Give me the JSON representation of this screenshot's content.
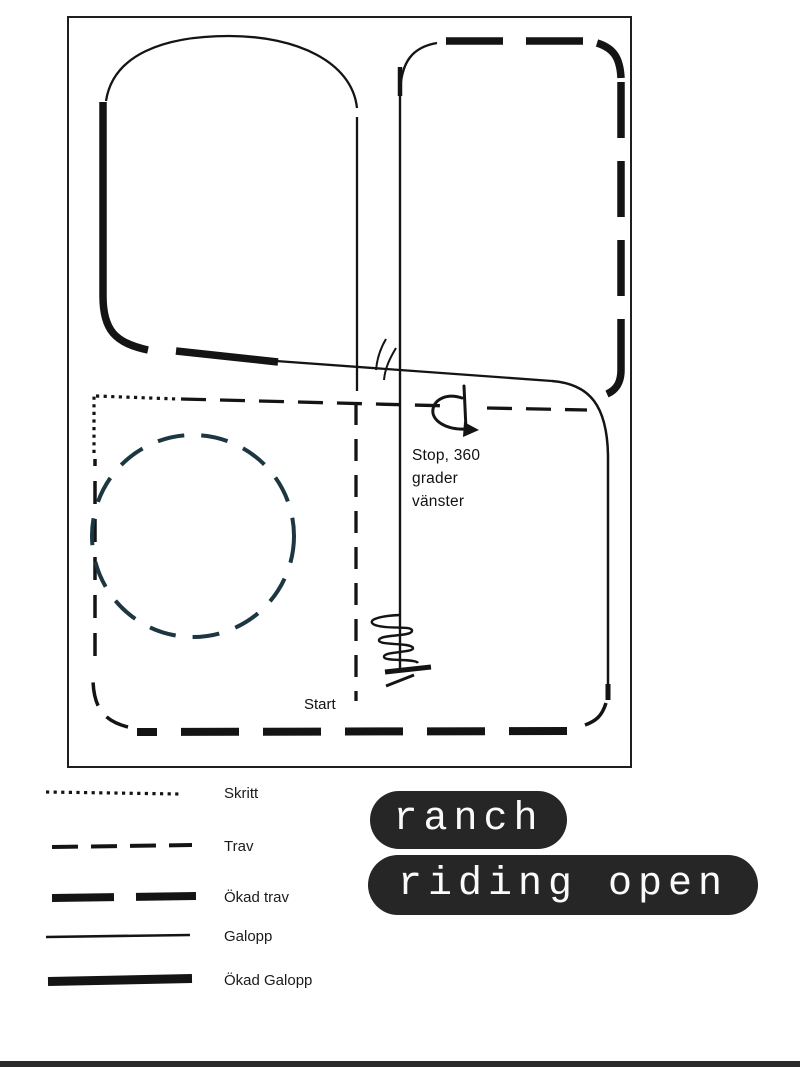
{
  "page": {
    "background_color": "#ffffff"
  },
  "pattern_map": {
    "frame_color": "#1f1f1f",
    "ink_color": "#141414",
    "circle_color": "#1c3642",
    "annotations": {
      "stop_note": {
        "lines": [
          "Stop, 360",
          "grader",
          "vänster"
        ]
      },
      "start_label": "Start"
    }
  },
  "legend": {
    "items": [
      {
        "label": "Skritt",
        "line_style": "dotted"
      },
      {
        "label": "Trav",
        "line_style": "dashed"
      },
      {
        "label": "Ökad trav",
        "line_style": "dashed-thick"
      },
      {
        "label": "Galopp",
        "line_style": "solid-thin"
      },
      {
        "label": "Ökad Galopp",
        "line_style": "solid-thick"
      }
    ]
  },
  "title_badges": {
    "line1": "ranch",
    "line2": "riding open",
    "background_color": "#262626",
    "text_color": "#fafafa"
  },
  "footer_bar": {
    "color": "#2b2b2b"
  }
}
